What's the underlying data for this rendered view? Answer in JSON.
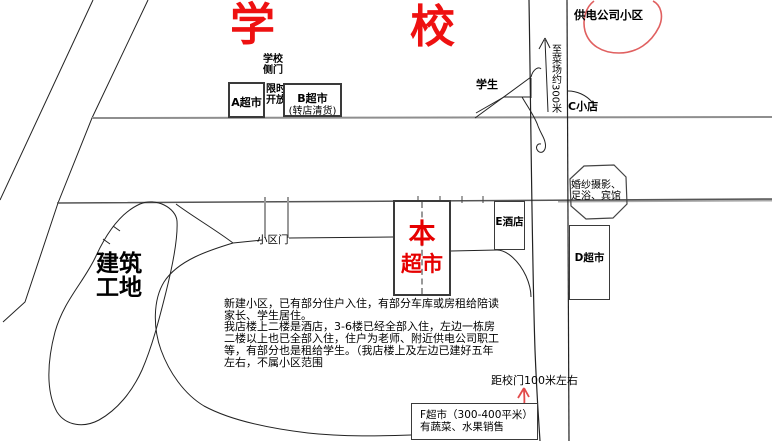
{
  "school": {
    "left_char": "学",
    "right_char": "校"
  },
  "top_right": {
    "power_company_area": "供电公司小区"
  },
  "north_shops": {
    "side_gate": "学校\n侧门",
    "limited_open": "限时\n开放",
    "supermarket_a": "A超市",
    "supermarket_b": "B超市",
    "supermarket_b_note": "(转店清货)",
    "c_shop": "C小店"
  },
  "crossing": {
    "students": "学生",
    "to_market": "至菜场约300米"
  },
  "east_side": {
    "wedding_block": "婚纱摄影、\n足浴、宾馆",
    "e_hotel": "E酒店",
    "d_supermarket": "D超市"
  },
  "our_store": {
    "line1": "本",
    "line2": "超市"
  },
  "community": {
    "gate": "小区门",
    "construction_site": "建筑\n工地",
    "note": "新建小区，已有部分住户入住，有部分车库或房租给陪读\n家长、学生居住。\n我店楼上二楼是酒店，3-6楼已经全部入住，左边一栋房\n二楼以上也已全部入住，住户为老师、附近供电公司职工\n等，有部分也是租给学生。（我店楼上及左边已建好五年\n左右，不属小区范围"
  },
  "south": {
    "distance": "距校门100米左右",
    "f_supermarket": "F超市（300-400平米）\n有蔬菜、水果销售"
  },
  "colors": {
    "accent_red": "#e60000",
    "sketch_red": "#e06060",
    "road_gray": "#8e8e8e",
    "line_black": "#222222",
    "dash_gray": "#999999"
  }
}
